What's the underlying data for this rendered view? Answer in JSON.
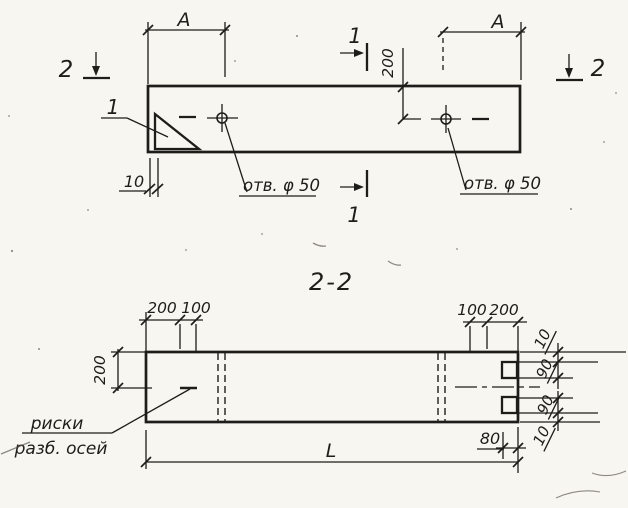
{
  "drawing": {
    "section_title": "2-2",
    "colors": {
      "paper": "#f7f6f1",
      "ink": "#1f1d1a"
    },
    "top_view": {
      "dim_A_left": "A",
      "dim_A_right": "A",
      "dim_200_to_hole": "200",
      "dim_10_end_offset": "10",
      "hole_label_left": "отв. φ 50",
      "hole_label_right": "отв. φ 50",
      "detail_mark": "1",
      "section1_mark_top": "1",
      "section1_mark_bottom": "1",
      "section2_mark_left": "2",
      "section2_mark_right": "2"
    },
    "bottom_view": {
      "dims_top_left": [
        "200",
        "100"
      ],
      "dims_top_right": [
        "100",
        "200"
      ],
      "dim_width_to_axis": "200",
      "dims_right_chain": [
        "10",
        "90",
        "90",
        "10"
      ],
      "dim_80_end": "80",
      "dim_length": "L",
      "note_line1": "риски",
      "note_line2": "разб. осей"
    }
  }
}
